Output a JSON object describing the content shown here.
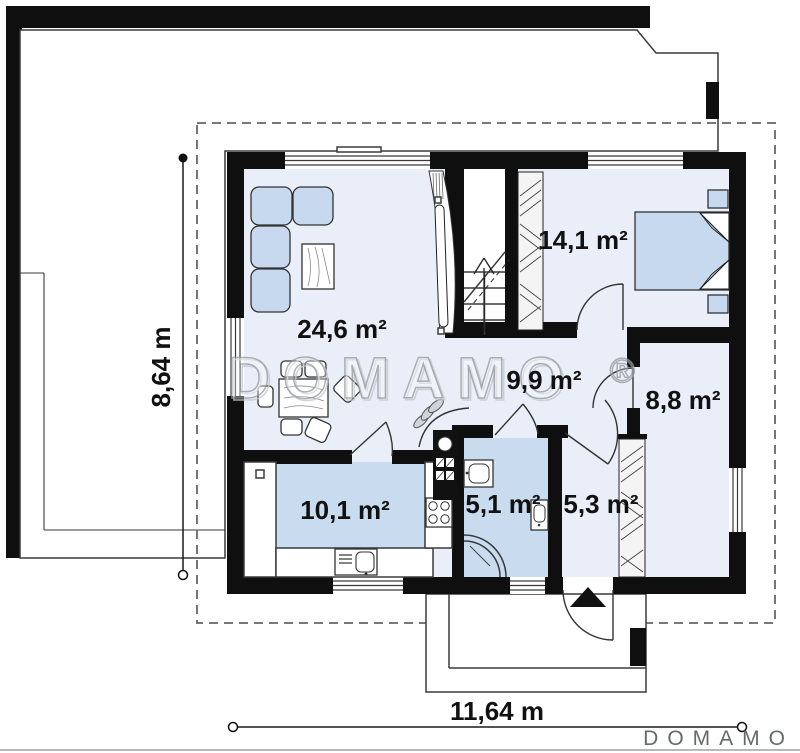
{
  "watermark": {
    "text": "DOMAMO",
    "reg": "®"
  },
  "brand_logo": {
    "text": "DOMAMO"
  },
  "dimensions": {
    "height": "8,64 m",
    "width": "11,64 m"
  },
  "rooms": [
    {
      "id": "living-room",
      "area": "24,6 m²"
    },
    {
      "id": "bedroom",
      "area": "14,1 m²"
    },
    {
      "id": "hall",
      "area": "9,9 m²"
    },
    {
      "id": "room",
      "area": "8,8 m²"
    },
    {
      "id": "kitchen",
      "area": "10,1 m²"
    },
    {
      "id": "bathroom",
      "area": "5,1 m²"
    },
    {
      "id": "entry-hall",
      "area": "5,3 m²"
    }
  ],
  "colors": {
    "wall": "#0f0f0f",
    "room_fill": "#e9eef8",
    "wet_fill": "#c9dbef",
    "furniture_fill": "#c7d9ee",
    "closet_fill": "#f4f4f4",
    "outline": "#3a3a3a",
    "dashed": "#666666",
    "watermark": "#9299a0",
    "logo": "#66696c",
    "text": "#111111"
  }
}
